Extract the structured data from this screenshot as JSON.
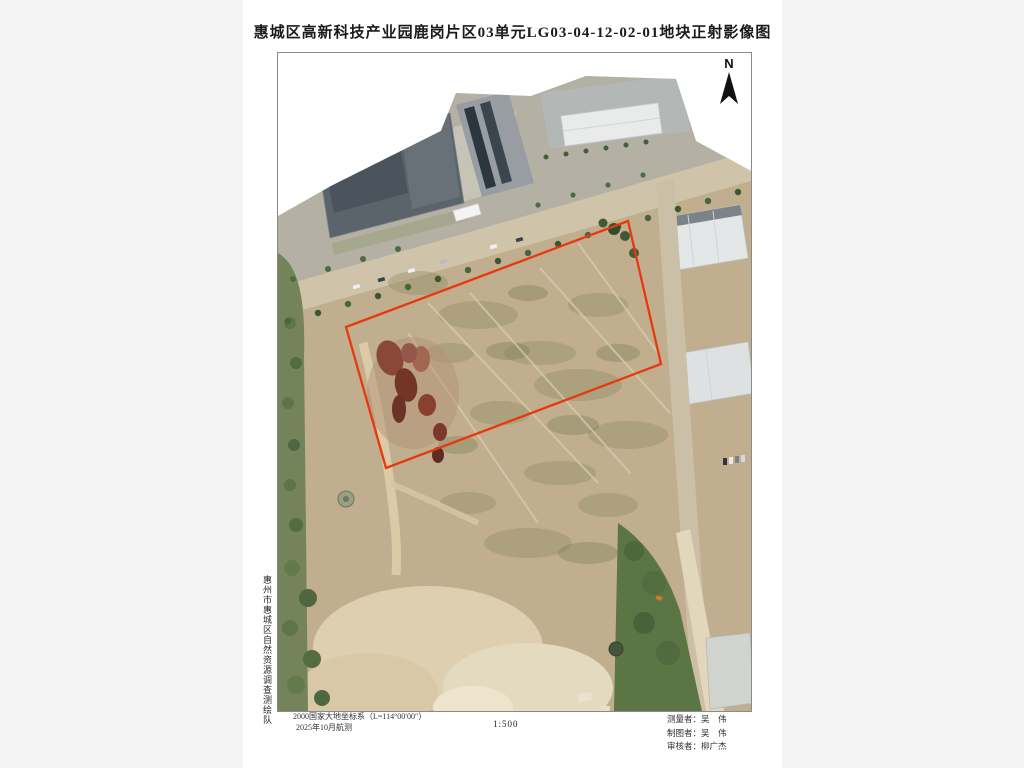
{
  "title": "惠城区高新科技产业园鹿岗片区03单元LG03-04-12-02-01地块正射影像图",
  "north": {
    "label": "N"
  },
  "side_label": "惠州市惠城区自然资源调查测绘队",
  "footer": {
    "datum_line1": "2000国家大地坐标系（L=114°00′00″）",
    "datum_line2": "2025年10月航测",
    "scale": "1:500",
    "credits": [
      "测量者：吴　伟",
      "制图者：吴　伟",
      "审核者：柳广杰"
    ]
  },
  "map": {
    "content": "无人机正射影像（地块用红线框示）",
    "boundary_color": "#e8380d",
    "boundary_points": "68,274 350,168 383,311 108,415",
    "frame_color": "#8a8a8a",
    "canvas_bg": "#f4f4f4",
    "page_bg": "#ffffff"
  }
}
